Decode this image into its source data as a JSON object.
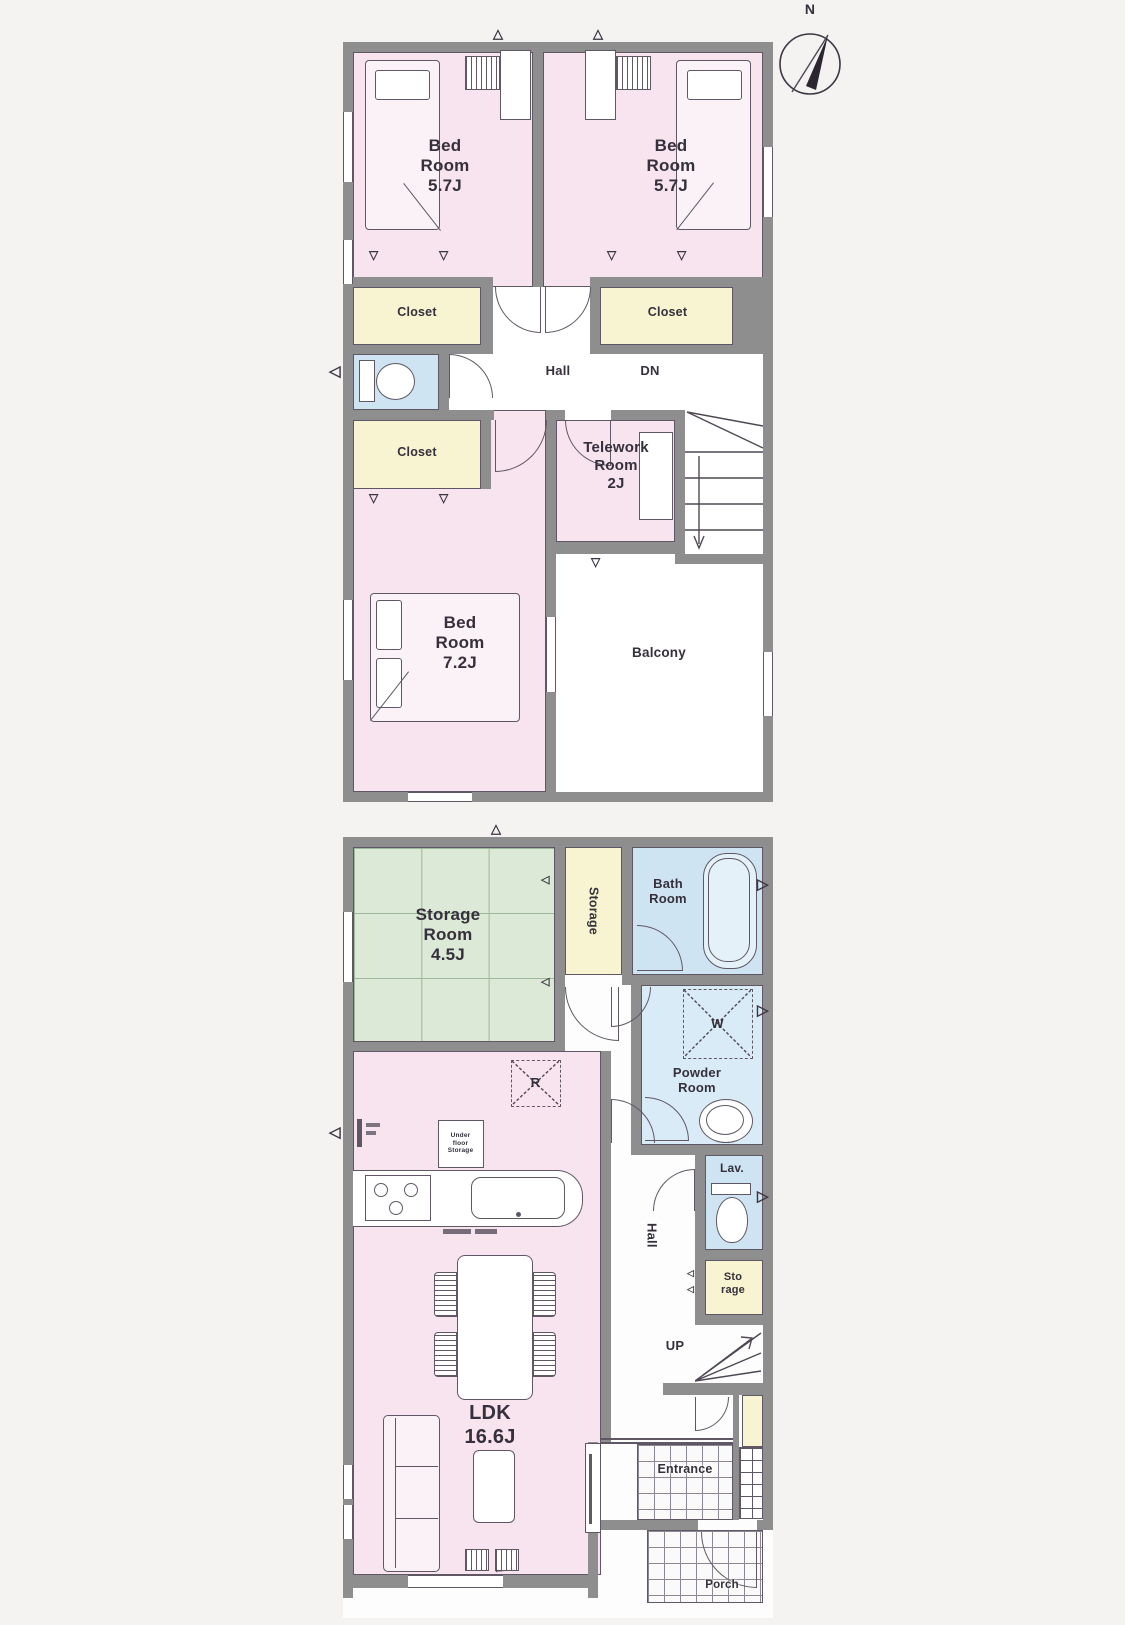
{
  "colors": {
    "room_pink": "#f7e4ee",
    "closet_yellow": "#f8f3d0",
    "wet_blue": "#cfe4f2",
    "powder_blue": "#d9ebf6",
    "tatami_green": "#dbe9d6",
    "wall_gray": "#8e8e8e",
    "line": "#5f5864",
    "text": "#35303b"
  },
  "compass": {
    "north": "N"
  },
  "floor2": {
    "bedroom_a": "Bed\nRoom\n5.7J",
    "bedroom_b": "Bed\nRoom\n5.7J",
    "closet_a": "Closet",
    "closet_b": "Closet",
    "closet_c": "Closet",
    "hall": "Hall",
    "down": "DN",
    "telework": "Telework\nRoom\n2J",
    "bedroom_c": "Bed\nRoom\n7.2J",
    "balcony": "Balcony"
  },
  "floor1": {
    "storage_room": "Storage\nRoom\n4.5J",
    "storage_upper": "Storage",
    "bath": "Bath\nRoom",
    "powder": "Powder\nRoom",
    "washer": "W",
    "fridge": "R",
    "under_floor": "Under\nfloor\nStorage",
    "hall": "Hall",
    "lav": "Lav.",
    "storage_small": "Sto\nrage",
    "up": "UP",
    "ldk": "LDK\n16.6J",
    "entrance": "Entrance",
    "porch": "Porch"
  }
}
